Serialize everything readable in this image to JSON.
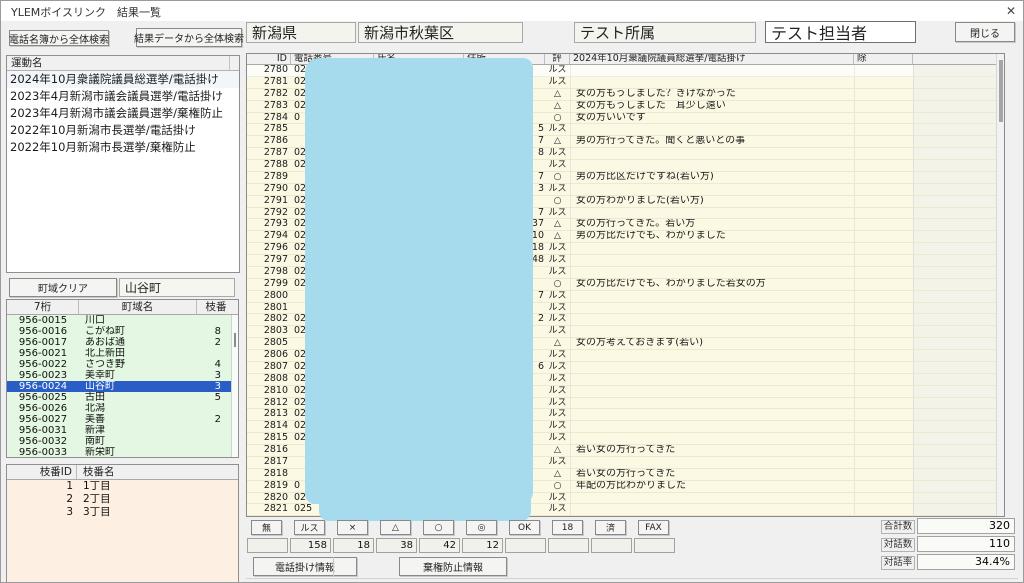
{
  "window": {
    "title": "YLEMボイスリンク　結果一覧",
    "close_glyph": "✕"
  },
  "topbar": {
    "search_phonebook": "電話名簿から全体検索",
    "search_results": "結果データから全体検索",
    "prefecture": "新潟県",
    "city": "新潟市秋葉区",
    "affiliation": "テスト所属",
    "operator": "テスト担当者",
    "close_button": "閉じる"
  },
  "campaigns": {
    "header": "運動名",
    "items": [
      "2024年10月衆議院議員総選挙/電話掛け",
      "2023年4月新潟市議会議員選挙/電話掛け",
      "2023年4月新潟市議会議員選挙/棄権防止",
      "2022年10月新潟市長選挙/電話掛け",
      "2022年10月新潟市長選挙/棄権防止"
    ]
  },
  "town": {
    "clear_button": "町域クリア",
    "input_value": "山谷町",
    "columns": [
      "7桁",
      "町域名",
      "枝番"
    ],
    "selected_index": 6,
    "rows": [
      [
        "956-0015",
        "川口",
        ""
      ],
      [
        "956-0016",
        "こがね町",
        "8"
      ],
      [
        "956-0017",
        "あおば通",
        "2"
      ],
      [
        "956-0021",
        "北上新田",
        ""
      ],
      [
        "956-0022",
        "さつき野",
        "4"
      ],
      [
        "956-0023",
        "美幸町",
        "3"
      ],
      [
        "956-0024",
        "山谷町",
        "3"
      ],
      [
        "956-0025",
        "古田",
        "5"
      ],
      [
        "956-0026",
        "北潟",
        ""
      ],
      [
        "956-0027",
        "美善",
        "2"
      ],
      [
        "956-0031",
        "新津",
        ""
      ],
      [
        "956-0032",
        "南町",
        ""
      ],
      [
        "956-0033",
        "新栄町",
        ""
      ]
    ]
  },
  "branch": {
    "columns": [
      "枝番ID",
      "枝番名"
    ],
    "rows": [
      [
        "1",
        "1丁目"
      ],
      [
        "2",
        "2丁目"
      ],
      [
        "3",
        "3丁目"
      ]
    ]
  },
  "results": {
    "columns": [
      "ID",
      "電話番号",
      "氏名",
      "住所",
      "評",
      "2024年10月衆議院議員総選挙/電話掛け",
      "除"
    ],
    "rows": [
      {
        "id": "2780",
        "phone": "02",
        "addr": "",
        "eval": "ルス",
        "comment": ""
      },
      {
        "id": "2781",
        "phone": "02",
        "addr": "",
        "eval": "ルス",
        "comment": ""
      },
      {
        "id": "2782",
        "phone": "02",
        "addr": "",
        "eval": "△",
        "comment": "女の方もうしました？きけなかった"
      },
      {
        "id": "2783",
        "phone": "02",
        "addr": "",
        "eval": "△",
        "comment": "女の方もうしました　耳少し遠い"
      },
      {
        "id": "2784",
        "phone": "0",
        "addr": "",
        "eval": "○",
        "comment": "女の方いいです"
      },
      {
        "id": "2785",
        "phone": "",
        "addr": "5",
        "eval": "ルス",
        "comment": ""
      },
      {
        "id": "2786",
        "phone": "",
        "addr": "7",
        "eval": "△",
        "comment": "男の方行ってきた。聞くと悪いとの事"
      },
      {
        "id": "2787",
        "phone": "0250",
        "addr": "8",
        "eval": "ルス",
        "comment": ""
      },
      {
        "id": "2788",
        "phone": "025",
        "addr": "",
        "eval": "ルス",
        "comment": ""
      },
      {
        "id": "2789",
        "phone": "",
        "addr": "7",
        "eval": "○",
        "comment": "男の方比区だけですね(若い方)"
      },
      {
        "id": "2790",
        "phone": "02",
        "addr": "3",
        "eval": "ルス",
        "comment": ""
      },
      {
        "id": "2791",
        "phone": "025",
        "addr": "",
        "eval": "○",
        "comment": "女の方わかりました(若い方)"
      },
      {
        "id": "2792",
        "phone": "02",
        "addr": "7",
        "eval": "ルス",
        "comment": ""
      },
      {
        "id": "2793",
        "phone": "025",
        "addr": "37",
        "eval": "△",
        "comment": "女の方行ってきた。若い方"
      },
      {
        "id": "2794",
        "phone": "025",
        "addr": "10",
        "eval": "△",
        "comment": "男の方比だけでも、わかりました"
      },
      {
        "id": "2796",
        "phone": "025",
        "addr": "18",
        "eval": "ルス",
        "comment": ""
      },
      {
        "id": "2797",
        "phone": "02",
        "addr": "48",
        "eval": "ルス",
        "comment": ""
      },
      {
        "id": "2798",
        "phone": "02",
        "addr": "",
        "eval": "ルス",
        "comment": ""
      },
      {
        "id": "2799",
        "phone": "02",
        "addr": "",
        "eval": "○",
        "comment": "女の方比だけでも、わかりました若女の方"
      },
      {
        "id": "2800",
        "phone": "",
        "addr": "7",
        "eval": "ルス",
        "comment": ""
      },
      {
        "id": "2801",
        "phone": "",
        "addr": "",
        "eval": "ルス",
        "comment": ""
      },
      {
        "id": "2802",
        "phone": "02",
        "addr": "2",
        "eval": "ルス",
        "comment": ""
      },
      {
        "id": "2803",
        "phone": "02",
        "addr": "",
        "eval": "ルス",
        "comment": ""
      },
      {
        "id": "2805",
        "phone": "",
        "addr": "",
        "eval": "△",
        "comment": "女の方考えておきます(若い)"
      },
      {
        "id": "2806",
        "phone": "02",
        "addr": "",
        "eval": "ルス",
        "comment": ""
      },
      {
        "id": "2807",
        "phone": "02",
        "addr": "6",
        "eval": "ルス",
        "comment": ""
      },
      {
        "id": "2808",
        "phone": "025",
        "addr": "",
        "eval": "ルス",
        "comment": ""
      },
      {
        "id": "2810",
        "phone": "025",
        "addr": "",
        "eval": "ルス",
        "comment": ""
      },
      {
        "id": "2812",
        "phone": "02",
        "addr": "",
        "eval": "ルス",
        "comment": ""
      },
      {
        "id": "2813",
        "phone": "02",
        "addr": "",
        "eval": "ルス",
        "comment": ""
      },
      {
        "id": "2814",
        "phone": "025",
        "addr": "",
        "eval": "ルス",
        "comment": ""
      },
      {
        "id": "2815",
        "phone": "025",
        "addr": "",
        "eval": "ルス",
        "comment": ""
      },
      {
        "id": "2816",
        "phone": "",
        "addr": "",
        "eval": "△",
        "comment": "若い女の方行ってきた"
      },
      {
        "id": "2817",
        "phone": "",
        "addr": "",
        "eval": "ルス",
        "comment": ""
      },
      {
        "id": "2818",
        "phone": "",
        "addr": "",
        "eval": "△",
        "comment": "若い女の方行ってきた"
      },
      {
        "id": "2819",
        "phone": "0",
        "addr": "",
        "eval": "○",
        "comment": "年配の方比わかりました"
      },
      {
        "id": "2820",
        "phone": "0250",
        "addr": "",
        "eval": "ルス",
        "comment": ""
      },
      {
        "id": "2821",
        "phone": "025",
        "addr": "",
        "eval": "ルス",
        "comment": ""
      }
    ]
  },
  "summary": {
    "buttons": [
      {
        "label": "無",
        "count": ""
      },
      {
        "label": "ルス",
        "count": "158"
      },
      {
        "label": "×",
        "count": "18"
      },
      {
        "label": "△",
        "count": "38"
      },
      {
        "label": "○",
        "count": "42"
      },
      {
        "label": "◎",
        "count": "12"
      },
      {
        "label": "OK",
        "count": ""
      },
      {
        "label": "18",
        "count": ""
      },
      {
        "label": "済",
        "count": ""
      },
      {
        "label": "FAX",
        "count": ""
      }
    ],
    "stats": [
      {
        "label": "合計数",
        "value": "320"
      },
      {
        "label": "対話数",
        "value": "110"
      },
      {
        "label": "対話率",
        "value": "34.4%"
      }
    ],
    "call_info_button": "電話掛け情報",
    "abstain_info_button": "棄権防止情報"
  },
  "colors": {
    "redaction": "#a6dbee",
    "selection": "#2a5ec6",
    "town_bg": "#e3f7e2",
    "branch_bg": "#fdf0e2",
    "table_bg": "#fbf8e3"
  }
}
